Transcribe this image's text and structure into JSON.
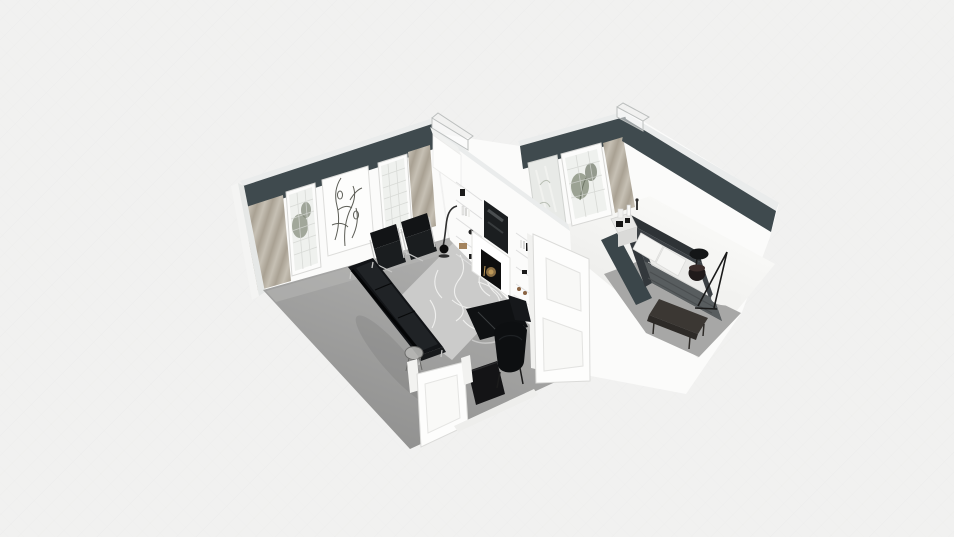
{
  "app": {
    "view_mode": "3d-dollhouse-floorplan"
  },
  "colors": {
    "background": "#f1f1f0",
    "hatch": "#e9e9e8",
    "accent_band": "#3f4a4e",
    "wall_white": "#fbfbfa",
    "wall_cap": "#eaecec",
    "living_floor": "#a2a2a1",
    "floor_reflection": "#b6b6b5",
    "rug": "#cbcbca",
    "rug_pattern": "#f4f4f2",
    "curtain": "#c2bcb0",
    "curtain_shadow": "#a89f90",
    "glass": "#eff1ee",
    "window_frame": "#fcfcfb",
    "plant": "#8d9584",
    "plant_dark": "#7d8575",
    "furniture_black": "#121417",
    "chrome": "#c7c7c6",
    "tv_screen": "#1b1e20",
    "firebox": "#0e0e0e",
    "brass": "#8a6e44",
    "door_white": "#fdfdfc",
    "door_edge": "#dbdbd9",
    "bed_frame": "#3c4145",
    "headboard": "#2e3336",
    "bedding": "#ebebe9",
    "pillow": "#f6f6f4",
    "blanket": "#585d5f",
    "bench": "#3b3733",
    "nightstand": "#e9e9e7",
    "bedroom_floor": "#f3f3f1",
    "bedroom_floor_shadow": "#a7a7a6",
    "divider_dark": "#3b464a",
    "ghost_outline": "#bcbfbe",
    "art_line": "#41423a"
  },
  "rooms": [
    {
      "id": "living-room",
      "furniture": [
        "sofa",
        "lounge-chair",
        "lounge-chair",
        "daybed-chaise",
        "accent-armchair",
        "floor-lamp",
        "wire-side-table",
        "media-console",
        "area-rug",
        "fireplace",
        "built-in-shelves",
        "wall-tv",
        "grid-window",
        "grid-window",
        "botanical-panel",
        "curtain",
        "curtain",
        "interior-door"
      ]
    },
    {
      "id": "bedroom",
      "furniture": [
        "double-bed",
        "nightstand",
        "bedside-table",
        "tripod-floor-lamp",
        "foot-bench",
        "round-rug",
        "grid-window",
        "glass-panel",
        "curtain",
        "interior-door"
      ]
    }
  ]
}
